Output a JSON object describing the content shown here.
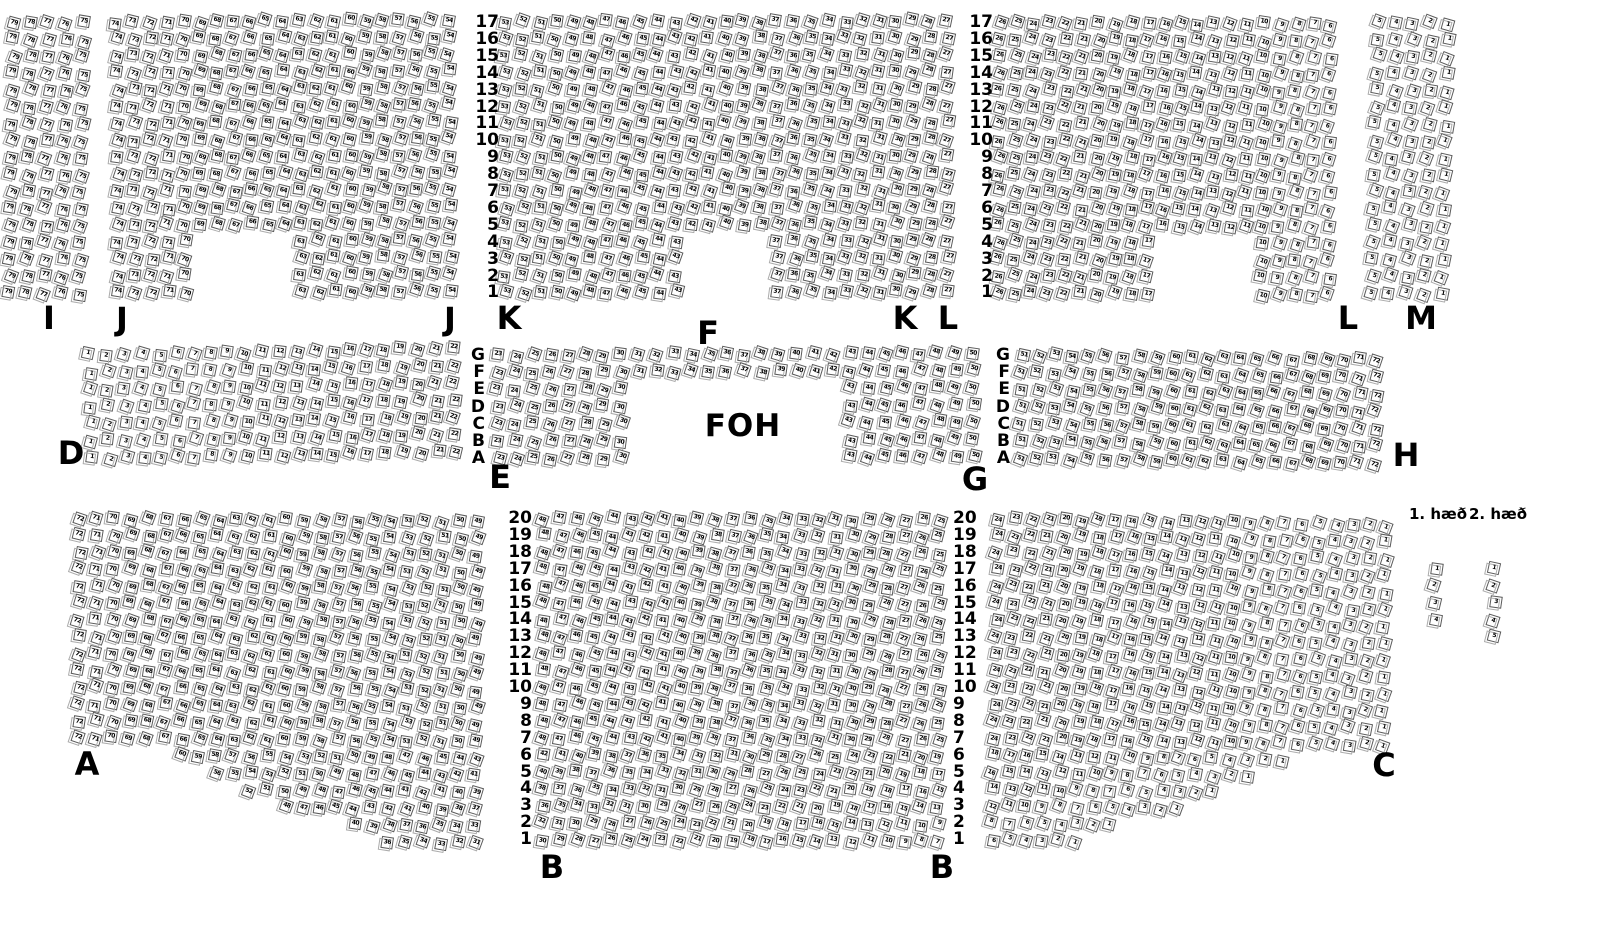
{
  "colors": {
    "background": "#ffffff",
    "ink": "#000000",
    "seat_border": "#5a5a5a",
    "seat_ghost": "#ababab"
  },
  "row_labels": {
    "top": [
      "17",
      "16",
      "15",
      "14",
      "13",
      "12",
      "11",
      "10",
      "9",
      "8",
      "7",
      "6",
      "5",
      "4",
      "3",
      "2",
      "1"
    ],
    "middle": [
      "G",
      "F",
      "E",
      "D",
      "C",
      "B",
      "A"
    ],
    "bottom": [
      "20",
      "19",
      "18",
      "17",
      "16",
      "15",
      "14",
      "13",
      "12",
      "11",
      "10",
      "9",
      "8",
      "7",
      "6",
      "5",
      "4",
      "3",
      "2",
      "1"
    ]
  },
  "row_label_columns": [
    {
      "id": "top-left-of-k",
      "x": 499,
      "y": 22,
      "dy": 16.9,
      "align": "right",
      "labels_ref": "top"
    },
    {
      "id": "top-left-of-l",
      "x": 993,
      "y": 22,
      "dy": 16.9,
      "align": "right",
      "labels_ref": "top"
    },
    {
      "id": "middle-left-of-e",
      "x": 485,
      "y": 355,
      "dy": 17.2,
      "align": "right",
      "labels_ref": "middle"
    },
    {
      "id": "middle-left-of-h",
      "x": 1010,
      "y": 355,
      "dy": 17.2,
      "align": "right",
      "labels_ref": "middle"
    },
    {
      "id": "bottom-left-of-b",
      "x": 532,
      "y": 518,
      "dy": 16.9,
      "align": "right",
      "labels_ref": "bottom"
    },
    {
      "id": "bottom-left-of-c",
      "x": 953,
      "y": 518,
      "dy": 16.9,
      "align": "left",
      "labels_ref": "bottom"
    }
  ],
  "section_labels": [
    {
      "text": "I",
      "x": 49,
      "y": 318,
      "type": "section"
    },
    {
      "text": "J",
      "x": 122,
      "y": 319,
      "type": "section"
    },
    {
      "text": "J",
      "x": 450,
      "y": 319,
      "type": "section"
    },
    {
      "text": "K",
      "x": 509,
      "y": 318,
      "type": "section"
    },
    {
      "text": "F",
      "x": 708,
      "y": 333,
      "type": "section"
    },
    {
      "text": "K",
      "x": 905,
      "y": 318,
      "type": "section"
    },
    {
      "text": "L",
      "x": 948,
      "y": 318,
      "type": "section"
    },
    {
      "text": "L",
      "x": 1348,
      "y": 318,
      "type": "section"
    },
    {
      "text": "M",
      "x": 1421,
      "y": 318,
      "type": "section"
    },
    {
      "text": "D",
      "x": 71,
      "y": 453,
      "type": "section"
    },
    {
      "text": "E",
      "x": 500,
      "y": 477,
      "type": "section"
    },
    {
      "text": "FOH",
      "x": 743,
      "y": 426,
      "type": "foh"
    },
    {
      "text": "G",
      "x": 975,
      "y": 479,
      "type": "section"
    },
    {
      "text": "H",
      "x": 1406,
      "y": 455,
      "type": "section"
    },
    {
      "text": "A",
      "x": 87,
      "y": 764,
      "type": "section"
    },
    {
      "text": "B",
      "x": 552,
      "y": 867,
      "type": "section"
    },
    {
      "text": "B",
      "x": 942,
      "y": 867,
      "type": "section"
    },
    {
      "text": "C",
      "x": 1384,
      "y": 765,
      "type": "section"
    },
    {
      "text": "1. hæð",
      "x": 1438,
      "y": 514,
      "type": "floor"
    },
    {
      "text": "2. hæð",
      "x": 1498,
      "y": 514,
      "type": "floor"
    }
  ],
  "seat_map": {
    "sections": [
      {
        "id": "I",
        "x": 14,
        "y": 22,
        "rows": 17,
        "cols": 5,
        "dx": 17.5,
        "dy": 16.9,
        "first": 79,
        "dir": -1,
        "rot": 1
      },
      {
        "id": "J",
        "x": 117,
        "y": 22,
        "rows": 17,
        "cols": 21,
        "dx": 16.6,
        "dy": 16.9,
        "first": 74,
        "dir": -1,
        "rot": -0.4,
        "gaps": [
          {
            "r0": 13,
            "r1": 16,
            "c0": 5,
            "c1": 10
          }
        ]
      },
      {
        "id": "K",
        "x": 505,
        "y": 22,
        "rows": 17,
        "cols": 27,
        "dx": 17.0,
        "dy": 16.9,
        "first": 53,
        "dir": -1,
        "rot": -0.2,
        "gaps": [
          {
            "r0": 13,
            "r1": 16,
            "c0": 11,
            "c1": 15
          }
        ]
      },
      {
        "id": "L",
        "x": 1000,
        "y": 22,
        "rows": 17,
        "cols": 21,
        "dx": 16.5,
        "dy": 16.9,
        "first": 26,
        "dir": -1,
        "rot": 0.4,
        "gaps": [
          {
            "r0": 13,
            "r1": 16,
            "c0": 10,
            "c1": 15
          }
        ]
      },
      {
        "id": "M",
        "x": 1379,
        "y": 22,
        "rows": 17,
        "cols": 5,
        "dx": 17.5,
        "dy": 16.9,
        "first": 5,
        "dir": -1,
        "rot": 1.5
      },
      {
        "id": "D",
        "x": 90,
        "y": 355,
        "rows": 7,
        "cols": 22,
        "dx": 17.3,
        "dy": 17.2,
        "first": 1,
        "dir": 1,
        "rot": -1.1
      },
      {
        "id": "EFG",
        "x": 498,
        "y": 355,
        "rows": 7,
        "cols": 28,
        "dx": 17.6,
        "dy": 17.2,
        "first": 23,
        "dir": 1,
        "rot": -0.3,
        "gaps": [
          {
            "r0": 2,
            "r1": 6,
            "c0": 8,
            "c1": 19
          }
        ]
      },
      {
        "id": "H",
        "x": 1022,
        "y": 355,
        "rows": 7,
        "cols": 22,
        "dx": 16.9,
        "dy": 17.2,
        "first": 51,
        "dir": 1,
        "rot": 0.8
      },
      {
        "id": "A",
        "x": 80,
        "y": 518,
        "rows": 20,
        "cols": 24,
        "dx": 17.3,
        "dy": 16.9,
        "first": 72,
        "dir": -1,
        "rot": 0.5,
        "row_overrides": {
          "14": {
            "skip": 6,
            "first": 60
          },
          "15": {
            "skip": 8,
            "first": 56
          },
          "16": {
            "skip": 10,
            "first": 52
          },
          "17": {
            "skip": 12,
            "first": 48
          },
          "18": {
            "skip": 16,
            "first": 40
          },
          "19": {
            "skip": 18,
            "first": 36
          }
        }
      },
      {
        "id": "B",
        "x": 544,
        "y": 518,
        "rows": 20,
        "cols": 24,
        "dx": 17.2,
        "dy": 16.9,
        "first": 48,
        "dir": -1,
        "rot": 0.3,
        "row_overrides": {
          "14": {
            "first": 42
          },
          "15": {
            "first": 40
          },
          "16": {
            "first": 38
          },
          "17": {
            "first": 36
          },
          "18": {
            "first": 32
          },
          "19": {
            "first": 30
          }
        }
      },
      {
        "id": "C",
        "x": 998,
        "y": 518,
        "rows": 20,
        "cols": 24,
        "dx": 16.9,
        "dy": 16.9,
        "first": 24,
        "dir": -1,
        "rot": 1.1,
        "row_overrides": {
          "14": {
            "cols": 18,
            "first": 18
          },
          "15": {
            "cols": 16,
            "first": 16
          },
          "16": {
            "cols": 14,
            "first": 14
          },
          "17": {
            "cols": 12,
            "first": 12
          },
          "18": {
            "cols": 8,
            "first": 8
          },
          "19": {
            "cols": 6,
            "first": 6
          }
        }
      },
      {
        "id": "floor-1",
        "x": 1435,
        "y": 568,
        "rows": 4,
        "cols": 1,
        "dx": 0,
        "dy": 17.3,
        "first": 1,
        "dir": 1,
        "rot": 0,
        "number_by": "row"
      },
      {
        "id": "floor-2",
        "x": 1494,
        "y": 568,
        "rows": 5,
        "cols": 1,
        "dx": 0,
        "dy": 17.2,
        "first": 1,
        "dir": 1,
        "rot": 0,
        "number_by": "row"
      }
    ]
  }
}
